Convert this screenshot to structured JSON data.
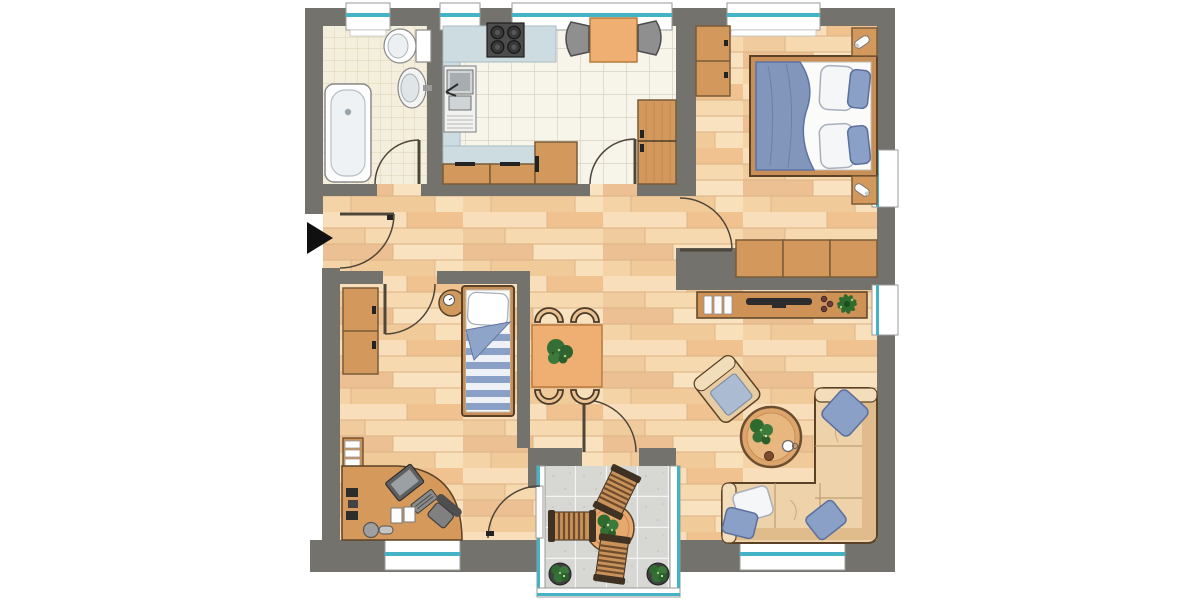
{
  "plan": {
    "type": "apartment-floor-plan",
    "colors": {
      "background": "#ffffff",
      "wall": "#73726c",
      "window_accent": "#45b3c6",
      "door_line": "#4f463a",
      "floor_wood": "#f3d3a5",
      "tile_bath": "#f4eedd",
      "tile_kitchen": "#f7f4ea",
      "tile_terrace": "#d7d7d4",
      "furniture_wood": "#d3995c",
      "furniture_wood_dark": "#7a5a36",
      "counter": "#cddce1",
      "appliance_dark": "#4c4c4c",
      "fabric_blue": "#8ba0c6",
      "fabric_white": "#f4f6f8",
      "sofa_tan": "#eed2a9",
      "table_orange": "#efae72",
      "plant_green": "#2f6b2f",
      "entrance_marker": "#101010"
    },
    "entrance": {
      "marker": "black-arrow-pointing-right",
      "side": "left-wall"
    },
    "windows": {
      "top_wall": 4,
      "right_wall": 2,
      "bottom_wall": 2
    },
    "doors": {
      "entrance": 1,
      "interior": 4,
      "terrace": 2
    },
    "rooms": [
      {
        "id": "bathroom",
        "floor": "small-ceramic-tile",
        "furniture": [
          "bathtub",
          "toilet",
          "wash-basin"
        ]
      },
      {
        "id": "kitchen",
        "floor": "ceramic-tile",
        "furniture": [
          "cooktop-4-burners",
          "double-sink-unit",
          "l-shaped-counter",
          "base-cabinets",
          "tall-cabinet",
          "breakfast-table",
          "two-gray-chairs"
        ]
      },
      {
        "id": "bedroom",
        "floor": "wood",
        "furniture": [
          "double-bed",
          "blue-duvet",
          "four-pillows",
          "two-nightstands-with-lamps",
          "wardrobe",
          "closet-row-3-units"
        ]
      },
      {
        "id": "hallway",
        "floor": "wood",
        "furniture": []
      },
      {
        "id": "childrens-room",
        "floor": "wood",
        "furniture": [
          "single-bed-striped-duvet",
          "round-bedside-table-with-clock",
          "wardrobe-2-units",
          "wall-bookshelf",
          "corner-desk",
          "monitor",
          "keyboard",
          "desk-books",
          "desk-phone",
          "office-chair"
        ]
      },
      {
        "id": "living-dining-room",
        "floor": "wood",
        "furniture": [
          "dining-table",
          "four-dining-chairs",
          "plant-centerpiece",
          "sideboard",
          "books",
          "tv",
          "decor-bowls",
          "potted-plant",
          "armchair",
          "round-coffee-table",
          "corner-sofa",
          "sofa-cushions"
        ]
      },
      {
        "id": "terrace",
        "floor": "stone-tile",
        "furniture": [
          "round-patio-table",
          "three-slatted-chairs",
          "two-potted-shrubs"
        ]
      }
    ]
  }
}
